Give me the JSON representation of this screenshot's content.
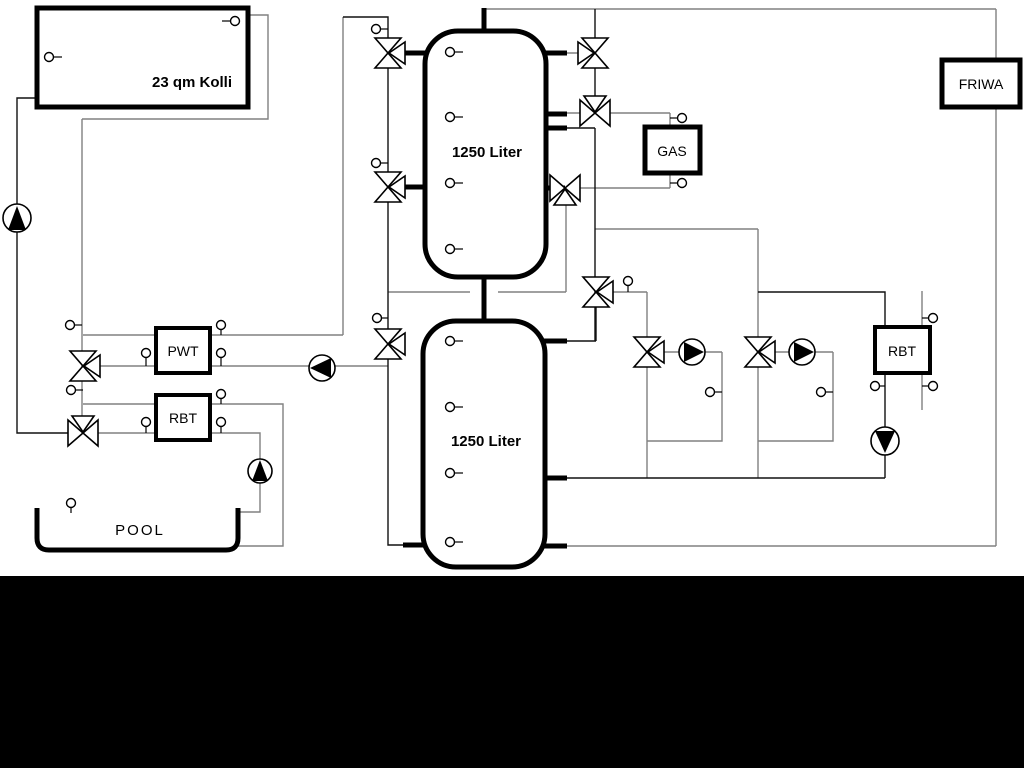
{
  "labels": {
    "collector": "23 qm Kolli",
    "tank1": "1250 Liter",
    "tank2": "1250 Liter",
    "pwt": "PWT",
    "rbt_left": "RBT",
    "gas": "GAS",
    "friwa": "FRIWA",
    "rbt_right": "RBT",
    "pool": "POOL"
  },
  "colors": {
    "background": "#ffffff",
    "bottom_band": "#000000",
    "pipe_gray": "#808080",
    "pipe_black": "#111111",
    "outline_black": "#000000"
  },
  "icons": {
    "pump": "circle-with-filled-triangle",
    "three_way_valve": "bowtie-triangles",
    "temp_sensor": "small-circle-with-stem"
  }
}
